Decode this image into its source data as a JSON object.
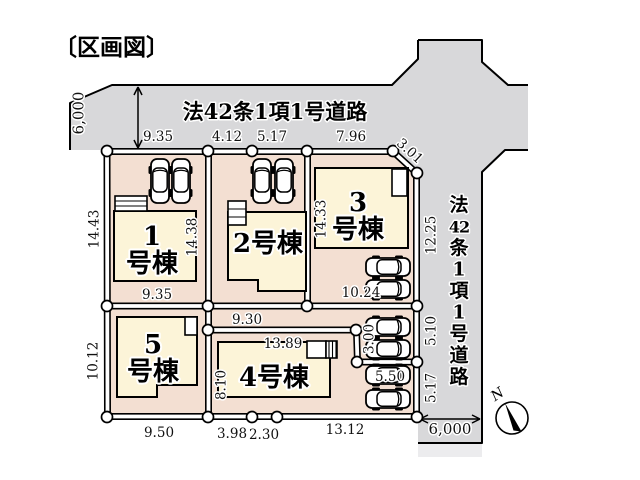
{
  "title": "〔区画図〕",
  "compass": {
    "north_label": "N"
  },
  "roads": {
    "top": {
      "label": "法42条1項1号道路",
      "width": "6,000"
    },
    "right": {
      "label": "法42条1項1号道路",
      "width": "6,000",
      "chars": [
        "法",
        "42",
        "条",
        "1",
        "項",
        "1",
        "号",
        "道",
        "路"
      ]
    }
  },
  "lots": [
    {
      "name": "1号棟",
      "lines": [
        "1",
        "号棟"
      ],
      "x": 152,
      "y": 245,
      "lh": 27
    },
    {
      "name": "2号棟",
      "lines": [
        "2号棟"
      ],
      "x": 268,
      "y": 252,
      "lh": 27
    },
    {
      "name": "3号棟",
      "lines": [
        "3",
        "号棟"
      ],
      "x": 358,
      "y": 211,
      "lh": 27
    },
    {
      "name": "4号棟",
      "lines": [
        "4号棟"
      ],
      "x": 274,
      "y": 386,
      "lh": 27
    },
    {
      "name": "5号棟",
      "lines": [
        "5",
        "号棟"
      ],
      "x": 153,
      "y": 353,
      "lh": 27
    }
  ],
  "dimensions": [
    {
      "v": "6,000",
      "x": 79,
      "y": 113,
      "r": -90,
      "s": 1
    },
    {
      "v": "9.35",
      "x": 158,
      "y": 141
    },
    {
      "v": "4.12",
      "x": 227,
      "y": 141
    },
    {
      "v": "5.17",
      "x": 272,
      "y": 141
    },
    {
      "v": "7.96",
      "x": 351,
      "y": 141
    },
    {
      "v": "3.01",
      "x": 410,
      "y": 151,
      "r": 42
    },
    {
      "v": "14.43",
      "x": 94,
      "y": 229,
      "r": -90
    },
    {
      "v": "14.38",
      "x": 192,
      "y": 237,
      "r": -90
    },
    {
      "v": "14.33",
      "x": 321,
      "y": 219,
      "r": -90
    },
    {
      "v": "12.25",
      "x": 431,
      "y": 235,
      "r": -90
    },
    {
      "v": "9.35",
      "x": 157,
      "y": 299
    },
    {
      "v": "9.30",
      "x": 247,
      "y": 324
    },
    {
      "v": "10.24",
      "x": 361,
      "y": 297
    },
    {
      "v": "5.10",
      "x": 431,
      "y": 331,
      "r": -90
    },
    {
      "v": "13.89",
      "x": 283,
      "y": 348
    },
    {
      "v": "8.10",
      "x": 221,
      "y": 385,
      "r": -90
    },
    {
      "v": "3.00",
      "x": 369,
      "y": 339,
      "r": -90
    },
    {
      "v": "5.50",
      "x": 390,
      "y": 381
    },
    {
      "v": "5.17",
      "x": 431,
      "y": 388,
      "r": -90
    },
    {
      "v": "10.12",
      "x": 93,
      "y": 361,
      "r": -90
    },
    {
      "v": "9.50",
      "x": 159,
      "y": 437
    },
    {
      "v": "3.98",
      "x": 232,
      "y": 438
    },
    {
      "v": "2.30",
      "x": 264,
      "y": 439
    },
    {
      "v": "13.12",
      "x": 345,
      "y": 434
    },
    {
      "v": "6,000",
      "x": 450,
      "y": 434,
      "s": 1
    }
  ],
  "colors": {
    "road": "#d8d8da",
    "lot": "#f3dfd2",
    "building": "#fcf4d8",
    "line": "#000000"
  }
}
